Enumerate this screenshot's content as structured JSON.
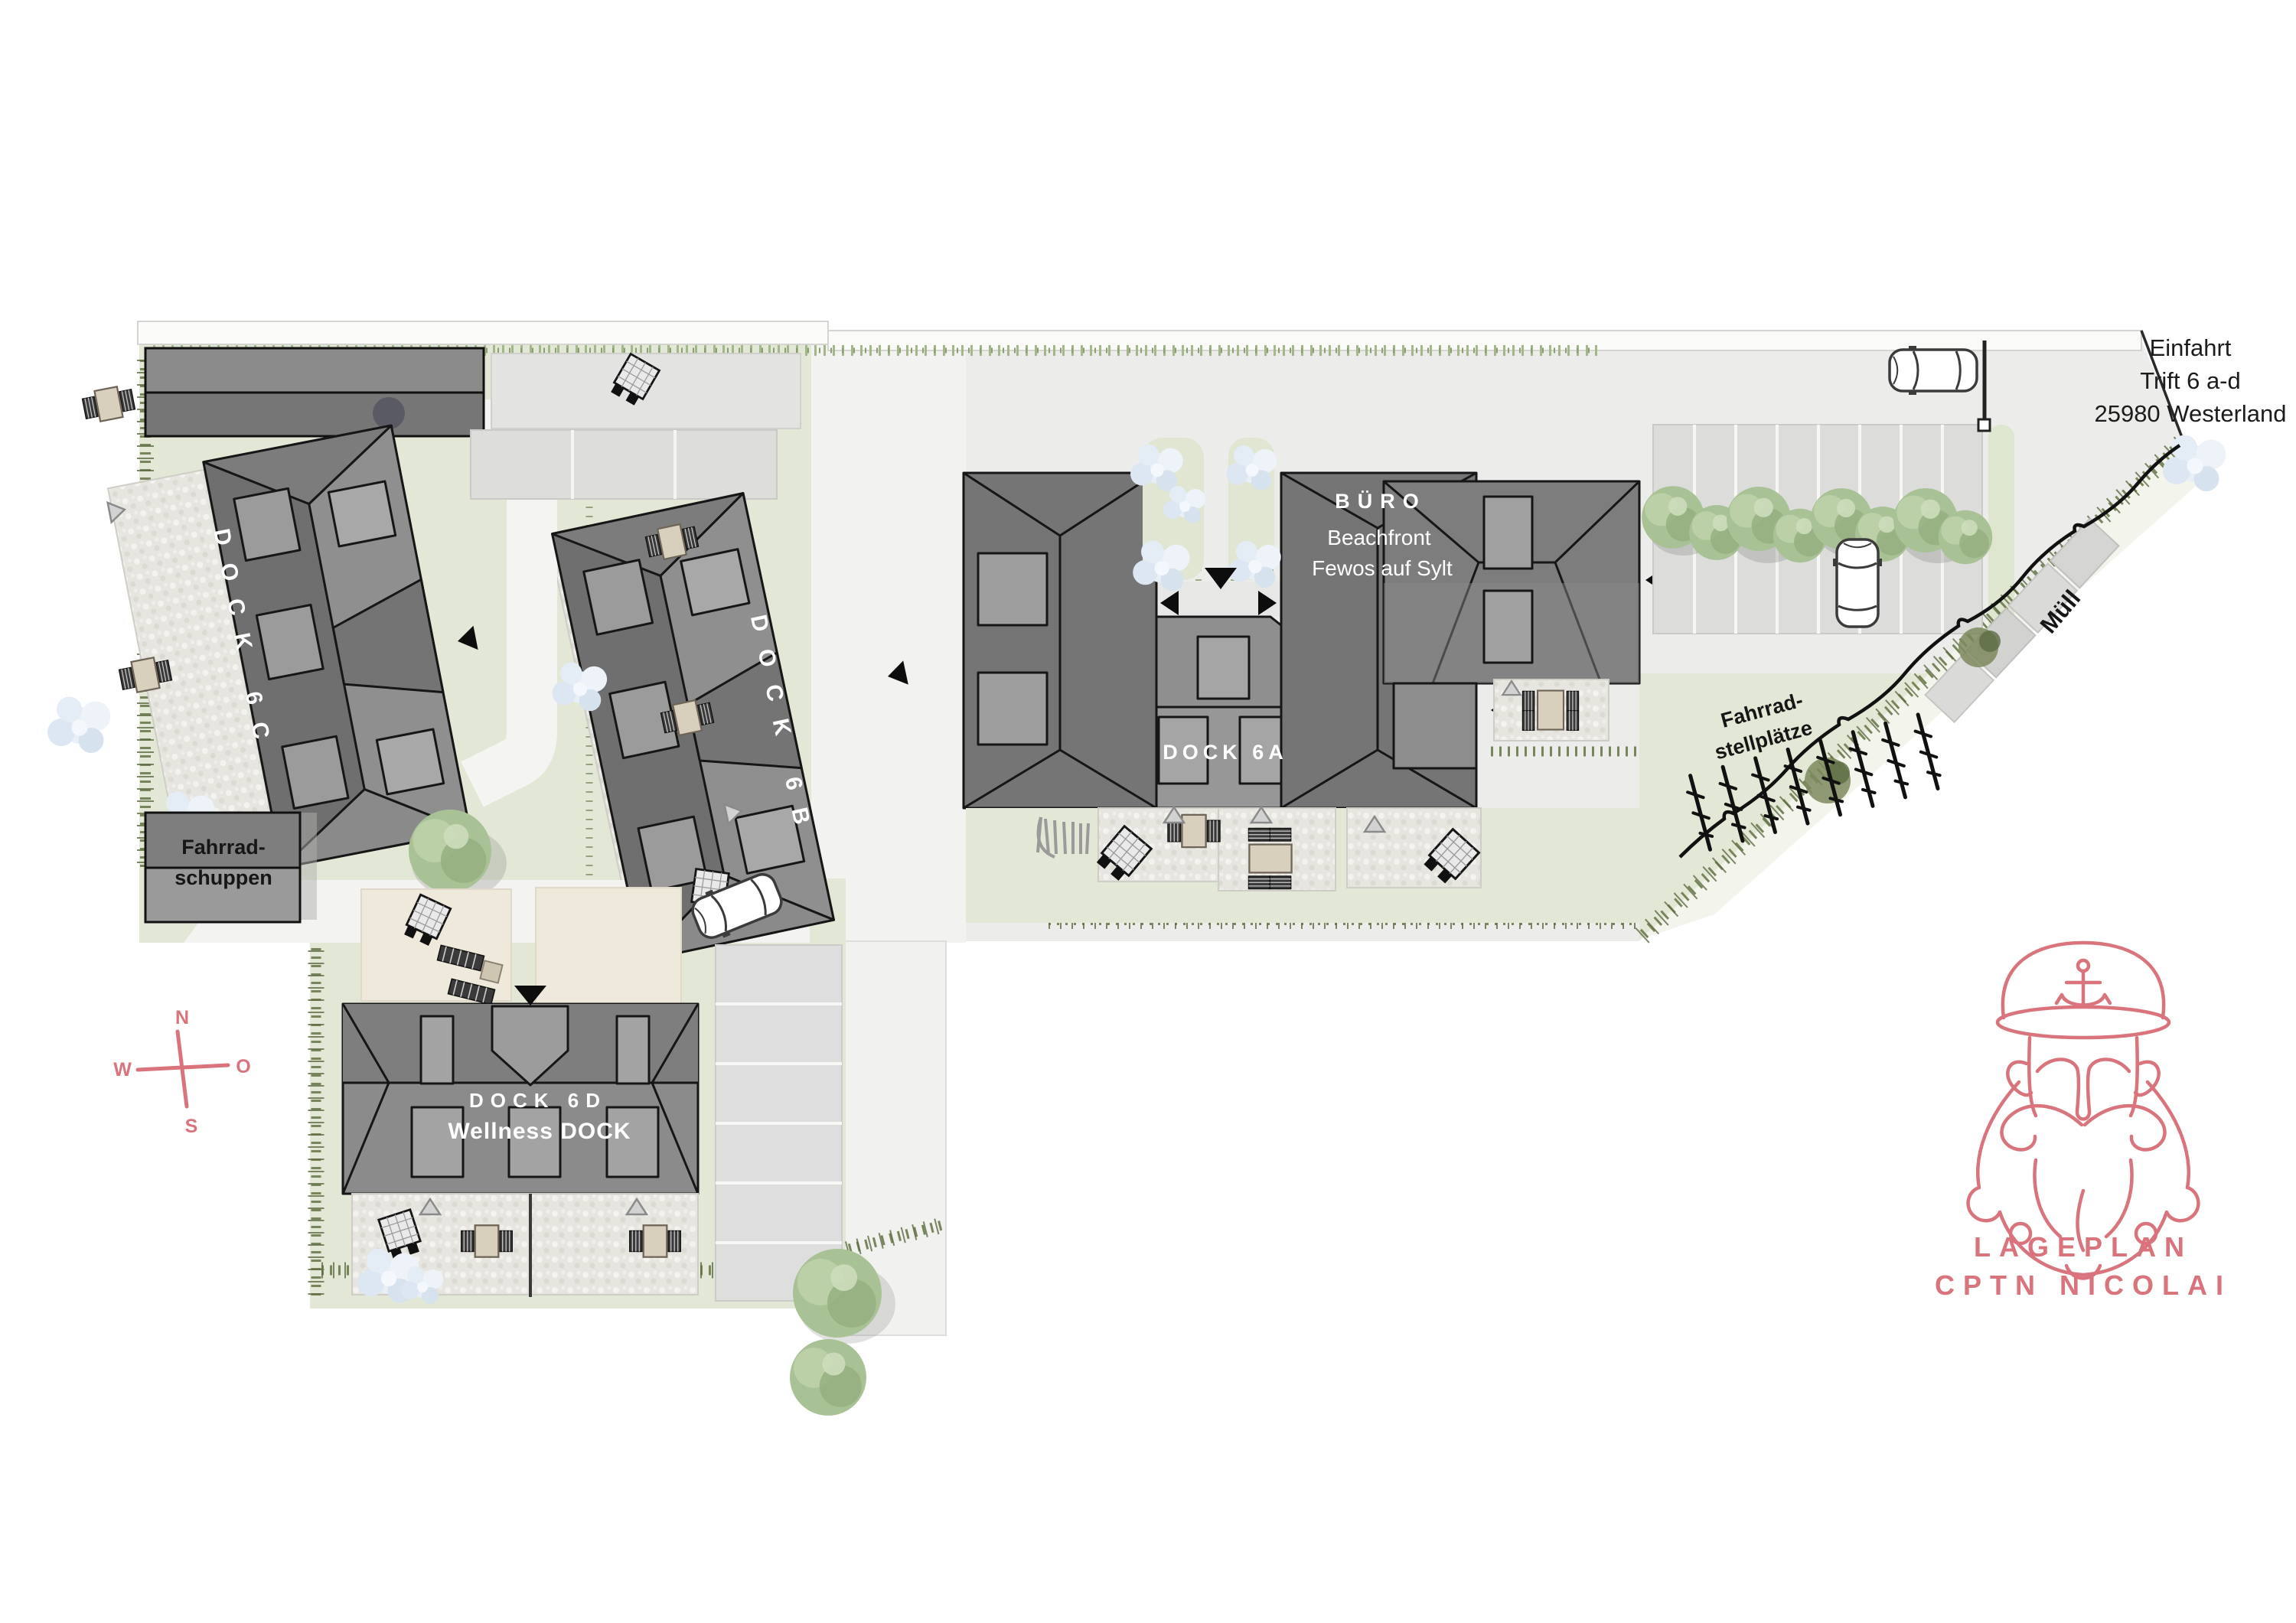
{
  "title": "Lageplan CPTN Nicolai",
  "labels": {
    "entrance_address": {
      "line1": "Einfahrt",
      "line2": "Trift 6 a-d",
      "line3": "25980 Westerland"
    },
    "buildings": {
      "dock6a": "DOCK 6A",
      "dock6b": "DOCK 6B",
      "dock6c": "DOCK 6C",
      "dock6d": "DOCK 6D",
      "dock6d_subtitle": "Wellness DOCK",
      "office_title": "BÜRO",
      "office_line1": "Beachfront",
      "office_line2": "Fewos auf Sylt"
    },
    "site": {
      "bike_shed_line1": "Fahrrad-",
      "bike_shed_line2": "schuppen",
      "bike_racks_line1": "Fahrrad-",
      "bike_racks_line2": "stellplätze",
      "waste": "Müll"
    },
    "compass": {
      "north": "N",
      "east": "O",
      "south": "S",
      "west": "W"
    },
    "logo": {
      "line1": "LAGEPLAN",
      "line2": "CPTN NICOLAI"
    }
  },
  "icons": {
    "compass-rose": "pink cross with N/O/S/W",
    "captain-logo": "pink line-art captain with anchor cap",
    "car": "top-view car outline",
    "tree": "green canopy blob",
    "entrance-arrow": "black triangle",
    "bike-rack": "vertical rack strokes"
  },
  "colors": {
    "accent_pink": "#d9737c",
    "building_dark": "#6f6f6f",
    "building_mid": "#8a8a8a",
    "roof_light": "#9e9e9e",
    "grass": "#e2e8d5",
    "paved": "#ececeb",
    "pebble": "#e7e5e0",
    "text_dark": "#1c1c1c",
    "label_light": "#ffffff"
  }
}
